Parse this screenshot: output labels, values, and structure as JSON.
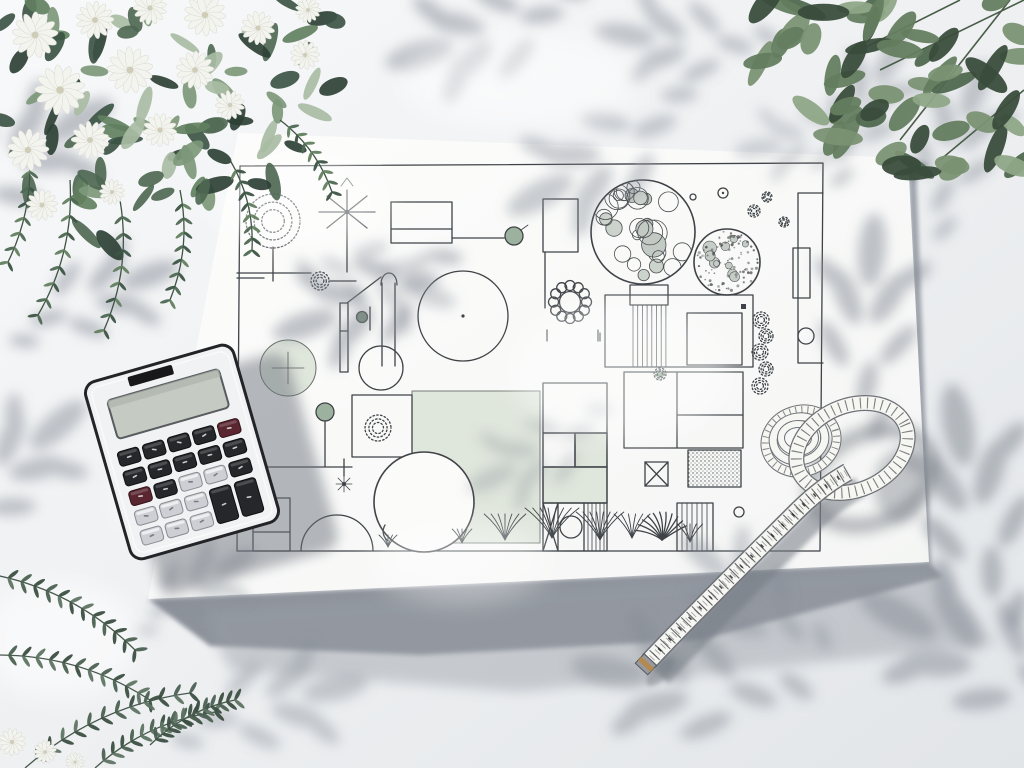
{
  "scene": {
    "description": "Top-down photo of a landscape garden design blueprint lying on a bright table. A pocket calculator rests on the left edge of the plan, a coiled tailor's measuring tape lies on the right, white jasmine-like flowers with dark foliage fill the top-left corner, a leafy green branch hangs into the top-right corner, sparse narrow-leaf sprigs enter from the bottom-left, and soft dappled leaf shadows fall across everything.",
    "objects": [
      {
        "name": "blueprint-paper",
        "label": "garden design plan sheet"
      },
      {
        "name": "garden-plan",
        "label": "hand-drawn landscape plan with tree symbols, lawn, pond, decking and gravel areas"
      },
      {
        "name": "calculator",
        "label": "white pocket calculator with dark and silver keys"
      },
      {
        "name": "measuring-tape",
        "label": "coiled soft measuring tape with metal tip"
      },
      {
        "name": "flowering-branch-top-left",
        "label": "white flowers and dark green foliage"
      },
      {
        "name": "leaf-branch-top-right",
        "label": "green leafy branch"
      },
      {
        "name": "leaf-branch-bottom-left",
        "label": "narrow-leaf sprigs"
      },
      {
        "name": "leaf-shadow-dapple",
        "label": "soft dappled foliage shadows"
      }
    ]
  },
  "palette": {
    "table": "#eef0f2",
    "table_dark": "#dfe2e6",
    "paper": "#fbfbfa",
    "paper_edge_shadow": "#9298a1",
    "plan_line": "#3f4347",
    "plan_green": "#dfe6dc",
    "plan_green_dot": "#9cb29e",
    "plan_green_dark": "#7d9280",
    "shadow": "#868c96",
    "calc_body": "#f1f2f4",
    "calc_rim": "#232428",
    "calc_display": "#c5cbc2",
    "calc_key_dark": "#26272b",
    "calc_key_light": "#cdcfd4",
    "calc_key_red": "#5a2630",
    "tape_white": "#f6f6f3",
    "tape_edge": "#6f7276",
    "tape_marks": "#2c2d2f",
    "tape_brass": "#b5894e",
    "foliage_tl": [
      "#2e4136",
      "#3c5444",
      "#4e6852",
      "#62805f",
      "#7d987a",
      "#a9bca4"
    ],
    "foliage_tr": [
      "#3a4d3c",
      "#50684f",
      "#647d5f",
      "#7b9273",
      "#8fa687"
    ],
    "foliage_bl": [
      "#3c4f42",
      "#4c6152",
      "#5f7463"
    ],
    "flower_white": "#f4f4ef",
    "flower_center": "#cfcdb8"
  },
  "counts": {
    "flowers_top_left": 16,
    "leaves_top_left": 85,
    "leaves_top_right": 60,
    "sprigs_bottom_left": 5,
    "calculator_key_rows": 5,
    "calculator_key_cols": 5
  }
}
